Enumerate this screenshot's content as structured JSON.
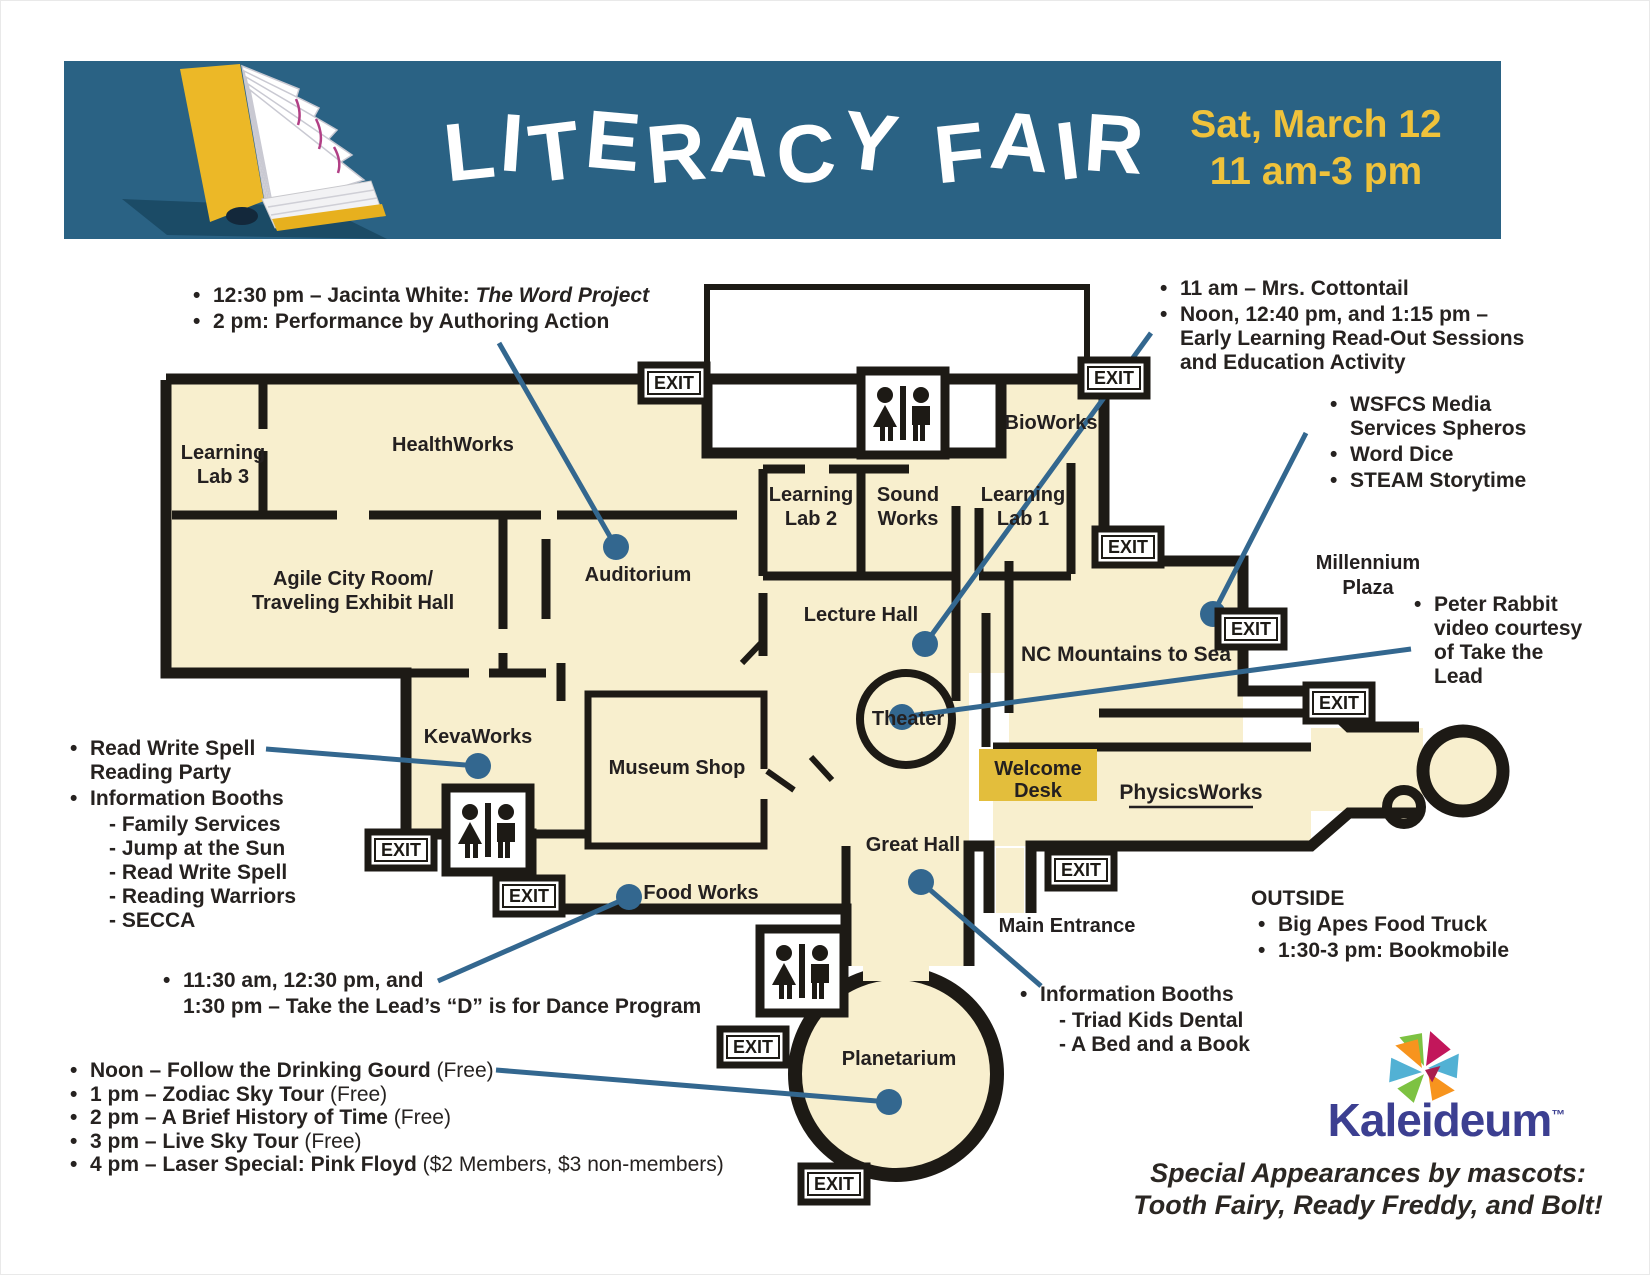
{
  "banner": {
    "title": "LITERACY FAIR",
    "date_line1": "Sat, March 12",
    "date_line2": "11 am-3 pm"
  },
  "map": {
    "exit_label": "EXIT",
    "colors": {
      "banner_blue": "#2a6284",
      "accent_yellow": "#efc23b",
      "floor_cream": "#f8efce",
      "wall_black": "#1d1a15",
      "leader_blue": "#33678f",
      "welcome_desk_gold": "#e3be3c"
    },
    "rooms": {
      "learning_lab_3": {
        "lines": [
          "Learning",
          "Lab 3"
        ]
      },
      "healthworks": {
        "label": "HealthWorks"
      },
      "agile_city": {
        "lines": [
          "Agile City Room/",
          "Traveling Exhibit Hall"
        ]
      },
      "auditorium": {
        "label": "Auditorium"
      },
      "learning_lab_2": {
        "lines": [
          "Learning",
          "Lab 2"
        ]
      },
      "sound_works": {
        "lines": [
          "Sound",
          "Works"
        ]
      },
      "learning_lab_1": {
        "lines": [
          "Learning",
          "Lab 1"
        ]
      },
      "bioworks": {
        "label": "BioWorks"
      },
      "lecture_hall": {
        "label": "Lecture Hall"
      },
      "nc_mountains": {
        "label": "NC Mountains to Sea"
      },
      "millennium_plaza": {
        "lines": [
          "Millennium",
          "Plaza"
        ]
      },
      "theater": {
        "label": "Theater"
      },
      "physicsworks": {
        "label": "PhysicsWorks"
      },
      "welcome_desk": {
        "lines": [
          "Welcome",
          "Desk"
        ]
      },
      "great_hall": {
        "label": "Great Hall"
      },
      "museum_shop": {
        "label": "Museum Shop"
      },
      "kevaworks": {
        "label": "KevaWorks"
      },
      "food_works": {
        "label": "Food Works"
      },
      "main_entrance": {
        "label": "Main Entrance"
      },
      "planetarium": {
        "label": "Planetarium"
      }
    }
  },
  "annotations": {
    "auditorium_events": {
      "items": [
        {
          "text": "12:30 pm – Jacinta White: ",
          "italic": "The Word Project"
        },
        {
          "text": "2 pm: Performance by Authoring Action"
        }
      ]
    },
    "theater_events": {
      "items": [
        {
          "text": "11 am – Mrs. Cottontail"
        },
        {
          "text": "Noon, 12:40 pm, and 1:15 pm – Early Learning Read-Out Sessions and Education Activity"
        }
      ]
    },
    "nc_mountains_events": {
      "items": [
        {
          "text": "WSFCS Media Services Spheros"
        },
        {
          "text": "Word Dice"
        },
        {
          "text": "STEAM Storytime"
        }
      ]
    },
    "theater_video": {
      "items": [
        {
          "text": "Peter Rabbit video courtesy of Take the Lead"
        }
      ]
    },
    "kevaworks_events": {
      "item1": "Read Write Spell Reading Party",
      "item2": "Information Booths",
      "subitems": [
        "- Family Services",
        "- Jump at the Sun",
        "- Read Write Spell",
        "- Reading Warriors",
        "- SECCA"
      ]
    },
    "food_works_events": {
      "lines": [
        "11:30 am, 12:30 pm, and",
        "1:30 pm – Take the Lead’s “D” is for Dance Program"
      ]
    },
    "planetarium_events": {
      "items": [
        {
          "bold": "Noon – Follow the Drinking Gourd",
          "regular": " (Free)"
        },
        {
          "bold": "1 pm – Zodiac Sky Tour",
          "regular": " (Free)"
        },
        {
          "bold": "2 pm – A Brief History of Time",
          "regular": " (Free)"
        },
        {
          "bold": "3 pm – Live Sky Tour",
          "regular": " (Free)"
        },
        {
          "bold": "4 pm – Laser Special: Pink Floyd",
          "regular": " ($2 Members, $3 non-members)"
        }
      ]
    },
    "great_hall_booths": {
      "item1": "Information Booths",
      "subitems": [
        "- Triad Kids Dental",
        "- A Bed and a Book"
      ]
    },
    "outside": {
      "heading": "OUTSIDE",
      "items": [
        {
          "text": "Big Apes Food Truck"
        },
        {
          "text": "1:30-3 pm: Bookmobile"
        }
      ]
    }
  },
  "footer": {
    "brand": "Kaleideum",
    "trademark": "™",
    "mascots_line1": "Special Appearances by mascots:",
    "mascots_line2": "Tooth Fairy, Ready Freddy, and Bolt!"
  }
}
